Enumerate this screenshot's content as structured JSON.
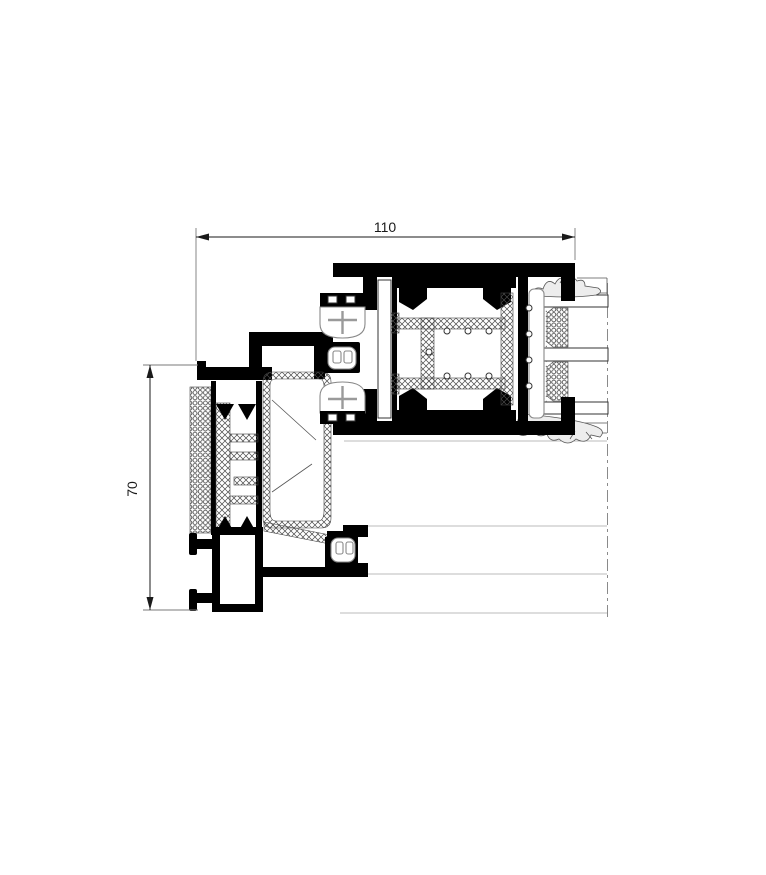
{
  "drawing": {
    "dimensions": {
      "horizontal": {
        "label": "110"
      },
      "vertical": {
        "label": "70"
      }
    },
    "colors": {
      "ink": "#000000",
      "hatch": "#4a4a4a",
      "phantom_line": "#bbbbbb",
      "centerline": "#8a8a8a",
      "gasket_gray": "#888888",
      "background": "#ffffff"
    }
  }
}
